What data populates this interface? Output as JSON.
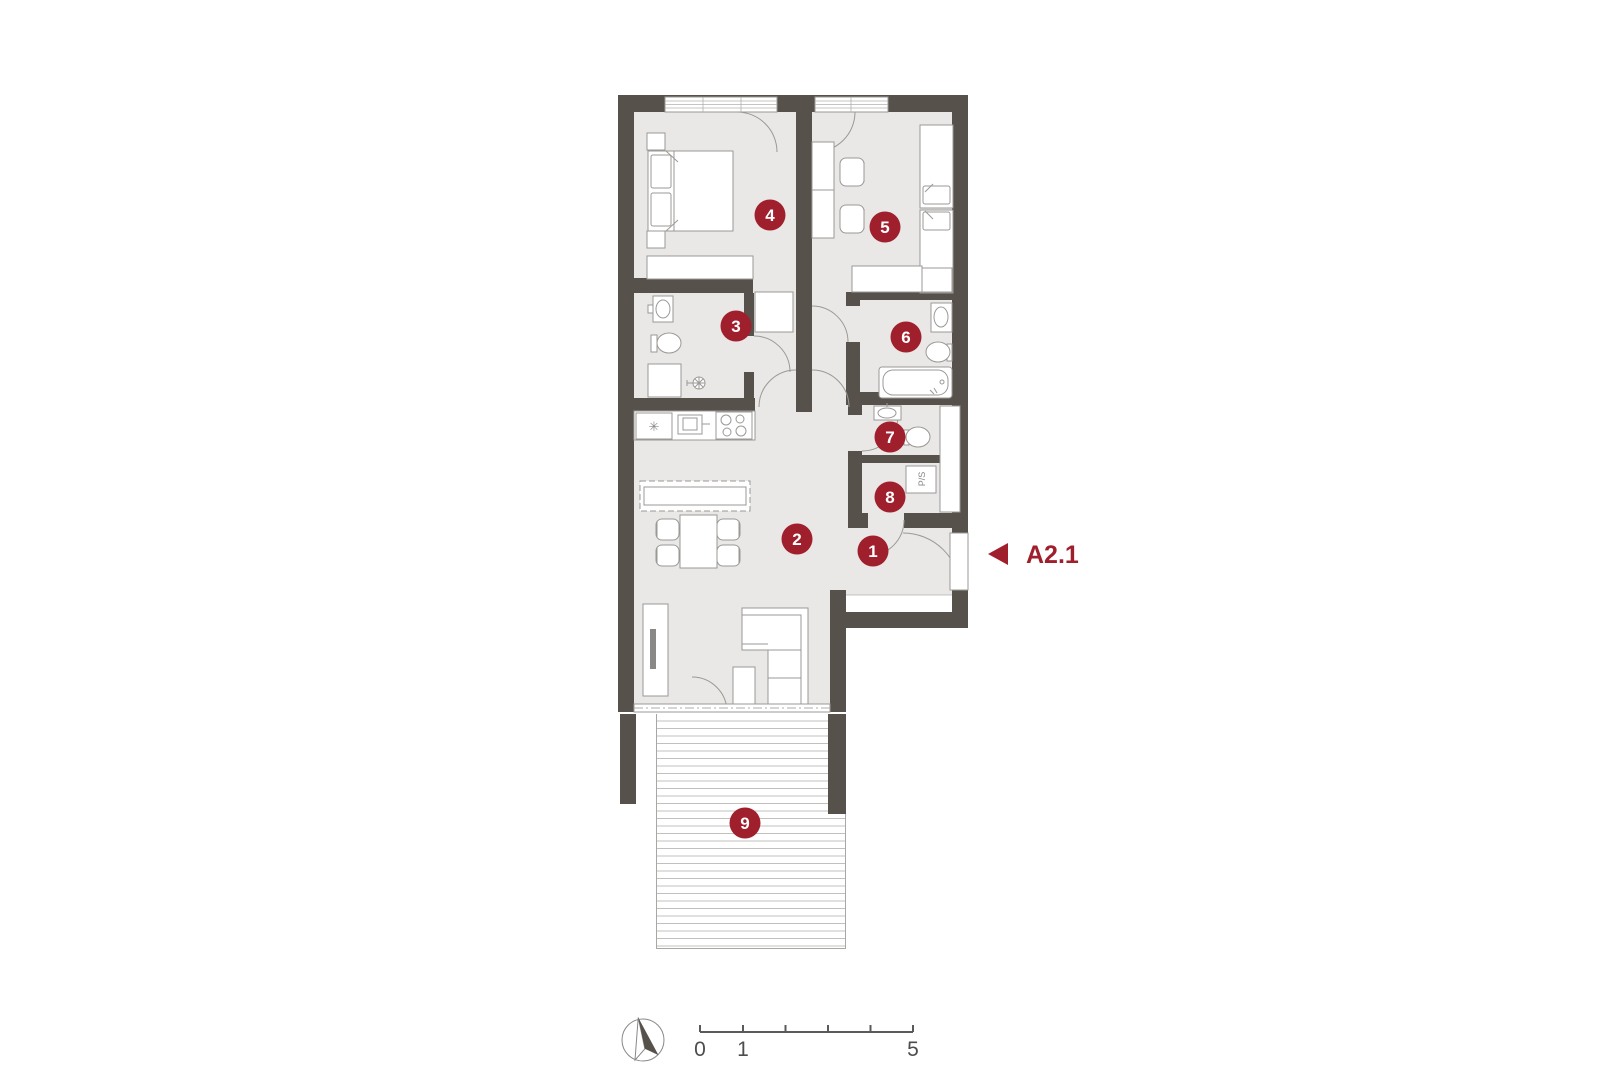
{
  "palette": {
    "wall": "#57514b",
    "floor": "#e9e8e6",
    "fixture_line": "#9b9995",
    "accent_red": "#a01f2c",
    "deck_line": "#c2c0bd",
    "scale_text": "#4d4d4d"
  },
  "plan": {
    "section_label": "A2.1",
    "utility_label": "P/S",
    "fridge_symbol": "✳",
    "markers": [
      {
        "n": "1"
      },
      {
        "n": "2"
      },
      {
        "n": "3"
      },
      {
        "n": "4"
      },
      {
        "n": "5"
      },
      {
        "n": "6"
      },
      {
        "n": "7"
      },
      {
        "n": "8"
      },
      {
        "n": "9"
      }
    ]
  },
  "scale_bar": {
    "labels": [
      "0",
      "1",
      "5"
    ]
  }
}
